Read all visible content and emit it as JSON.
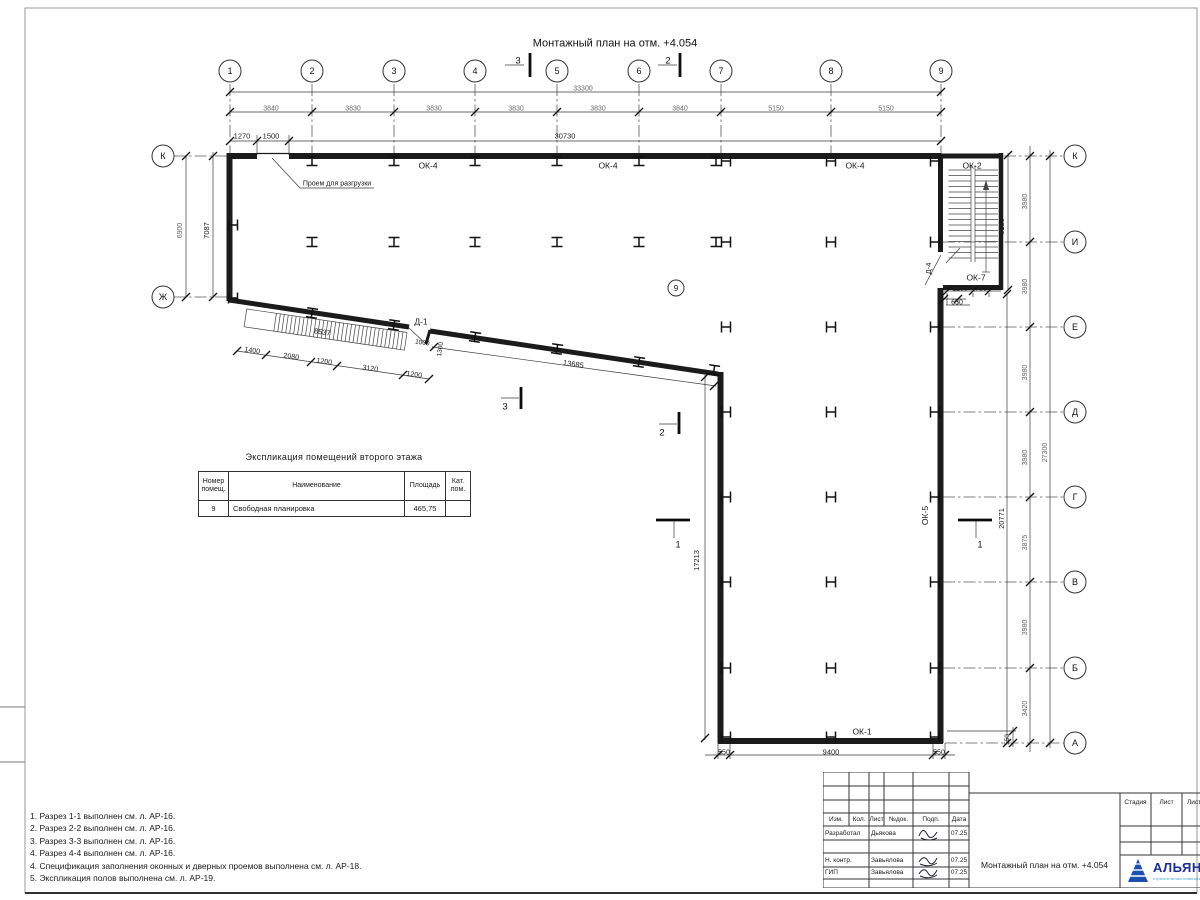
{
  "sheet_title": "Монтажный план на отм. +4.054",
  "axes": {
    "numbers": [
      "1",
      "2",
      "3",
      "4",
      "5",
      "6",
      "7",
      "8",
      "9"
    ],
    "letters_left": [
      "К",
      "Ж"
    ],
    "letters_right": [
      "К",
      "И",
      "Е",
      "Д",
      "Г",
      "В",
      "Б",
      "А"
    ],
    "room_number": "9"
  },
  "expl_table": {
    "title": "Экспликация помещений второго этажа",
    "col_headers": [
      "Номер помещ.",
      "Наименование",
      "Площадь",
      "Кат. пом."
    ],
    "row": {
      "num": "9",
      "name": "Свободная планировка",
      "area": "465,75",
      "cat": ""
    }
  },
  "notes": [
    "1. Разрез 1-1 выполнен см. л. АР-16.",
    "2. Разрез 2-2 выполнен см. л. АР-16.",
    "3. Разрез 3-3 выполнен см. л. АР-16.",
    "4. Разрез 4-4 выполнен см. л. АР-16.",
    "4. Спецификация заполнения оконных и дверных проемов выполнена см. л. АР-18.",
    "5. Экспликация полов выполнена см. л. АР-19."
  ],
  "titleblock": {
    "header_cells": [
      "Изм.",
      "Кол.",
      "Лист",
      "№док.",
      "Подп.",
      "Дата"
    ],
    "rows": [
      [
        "Разработал",
        "Дьякова",
        "07.25"
      ],
      [
        "Н. контр.",
        "Завьялова",
        "07.25"
      ],
      [
        "ГИП",
        "Завьялова",
        "07.25"
      ]
    ],
    "doc_title": "Монтажный план на отм. +4.054",
    "stage_headers": [
      "Стадия",
      "Лист",
      "Листов"
    ],
    "logo_name": "АЛЬЯНС",
    "logo_sub": "строительная компания",
    "logo_color": "#1d2f8f",
    "logo_accent": "#2a9fd4"
  },
  "plan": {
    "dash": [
      [
        230,
        84,
        230,
        158
      ],
      [
        312,
        84,
        312,
        158
      ],
      [
        394,
        84,
        394,
        158
      ],
      [
        475,
        84,
        475,
        158
      ],
      [
        557,
        84,
        557,
        158
      ],
      [
        639,
        84,
        639,
        158
      ],
      [
        721,
        84,
        721,
        158
      ],
      [
        831,
        84,
        831,
        158
      ],
      [
        941,
        84,
        941,
        158
      ],
      [
        174,
        156,
        228,
        156
      ],
      [
        174,
        297,
        228,
        297
      ],
      [
        1004,
        156,
        1064,
        156
      ],
      [
        943,
        242,
        1064,
        242
      ],
      [
        943,
        327,
        1064,
        327
      ],
      [
        943,
        412,
        1064,
        412
      ],
      [
        943,
        497,
        1064,
        497
      ],
      [
        943,
        582,
        1064,
        582
      ],
      [
        943,
        668,
        1064,
        668
      ],
      [
        945,
        743,
        1064,
        743
      ]
    ],
    "thin": [
      [
        230,
        92,
        941,
        92
      ],
      [
        230,
        112,
        941,
        112
      ],
      [
        230,
        141,
        941,
        141
      ],
      [
        186,
        156,
        186,
        297
      ],
      [
        213,
        152,
        213,
        297
      ],
      [
        1030,
        146,
        1030,
        752
      ],
      [
        1050,
        150,
        1050,
        748
      ],
      [
        1007,
        294,
        1007,
        743
      ],
      [
        1008,
        153,
        1008,
        290
      ],
      [
        944,
        291,
        1001,
        291
      ],
      [
        944,
        299,
        966,
        299
      ],
      [
        705,
        755,
        955,
        755
      ],
      [
        947,
        731,
        1016,
        731
      ],
      [
        1013,
        727,
        1013,
        747
      ],
      [
        237,
        351,
        429,
        379
      ],
      [
        432,
        347,
        716,
        386
      ],
      [
        705,
        375,
        705,
        740
      ],
      [
        257,
        135,
        257,
        155
      ],
      [
        289,
        135,
        289,
        155
      ],
      [
        718,
        743,
        718,
        759
      ],
      [
        730,
        743,
        730,
        759
      ],
      [
        933,
        743,
        933,
        759
      ],
      [
        945,
        743,
        945,
        759
      ],
      [
        947,
        293,
        947,
        305
      ],
      [
        973,
        293,
        973,
        297
      ],
      [
        989,
        293,
        989,
        297
      ],
      [
        958,
        299,
        958,
        305
      ],
      [
        272,
        158,
        300,
        188
      ],
      [
        300,
        188,
        374,
        188
      ],
      [
        946,
        305,
        970,
        305
      ],
      [
        505,
        65,
        524,
        65
      ],
      [
        658,
        65,
        677,
        65
      ],
      [
        501,
        398,
        519,
        398
      ],
      [
        659,
        424,
        677,
        424
      ],
      [
        674,
        520,
        674,
        538
      ],
      [
        976,
        520,
        976,
        538
      ],
      [
        409,
        328,
        427,
        345
      ],
      [
        941,
        255,
        925,
        285
      ],
      [
        946,
        263,
        960,
        248
      ]
    ],
    "ticks": [
      [
        230,
        92
      ],
      [
        941,
        92
      ],
      [
        230,
        112
      ],
      [
        312,
        112
      ],
      [
        394,
        112
      ],
      [
        475,
        112
      ],
      [
        557,
        112
      ],
      [
        639,
        112
      ],
      [
        721,
        112
      ],
      [
        831,
        112
      ],
      [
        941,
        112
      ],
      [
        230,
        141
      ],
      [
        257,
        141
      ],
      [
        289,
        141
      ],
      [
        941,
        141
      ],
      [
        186,
        156
      ],
      [
        186,
        297
      ],
      [
        213,
        156
      ],
      [
        213,
        297
      ],
      [
        1030,
        156
      ],
      [
        1030,
        242
      ],
      [
        1030,
        327
      ],
      [
        1030,
        412
      ],
      [
        1030,
        497
      ],
      [
        1030,
        582
      ],
      [
        1030,
        668
      ],
      [
        1030,
        743
      ],
      [
        1050,
        156
      ],
      [
        1050,
        743
      ],
      [
        1007,
        294
      ],
      [
        1007,
        743
      ],
      [
        1008,
        155
      ],
      [
        1008,
        290
      ],
      [
        947,
        291
      ],
      [
        973,
        291
      ],
      [
        989,
        291
      ],
      [
        944,
        299
      ],
      [
        958,
        299
      ],
      [
        718,
        755
      ],
      [
        730,
        755
      ],
      [
        933,
        755
      ],
      [
        945,
        755
      ],
      [
        1013,
        731
      ],
      [
        1013,
        743
      ],
      [
        237,
        351
      ],
      [
        266,
        355
      ],
      [
        311,
        362
      ],
      [
        337,
        366
      ],
      [
        403,
        375
      ],
      [
        429,
        379
      ],
      [
        434,
        347
      ],
      [
        714,
        386
      ],
      [
        705,
        377
      ],
      [
        705,
        738
      ]
    ],
    "walls": [
      [
        227,
        156,
        257,
        156,
        6
      ],
      [
        257,
        153.5,
        289,
        153.5,
        1.2
      ],
      [
        289,
        156,
        941,
        156,
        6
      ],
      [
        941,
        156,
        1003,
        156,
        5
      ],
      [
        229.5,
        153,
        229.5,
        301,
        6
      ],
      [
        229,
        300,
        409,
        327,
        5
      ],
      [
        430,
        331,
        718,
        374,
        5
      ],
      [
        430,
        330,
        426,
        344,
        3
      ],
      [
        720.5,
        372,
        720.5,
        743,
        6
      ],
      [
        718,
        741,
        943,
        741,
        6
      ],
      [
        940.5,
        156,
        940.5,
        252,
        5
      ],
      [
        940.5,
        288,
        940.5,
        743,
        6
      ],
      [
        1001,
        153,
        1001,
        290,
        4.5
      ],
      [
        943,
        287.5,
        1003,
        287.5,
        5
      ]
    ],
    "bars": [
      [
        530,
        53,
        530,
        77
      ],
      [
        680,
        53,
        680,
        77
      ],
      [
        521,
        387,
        521,
        409
      ],
      [
        679,
        412,
        679,
        434
      ],
      [
        656,
        520,
        690,
        520
      ],
      [
        958,
        520,
        992,
        520
      ]
    ],
    "cols": [
      [
        312,
        161,
        "v",
        0
      ],
      [
        394,
        161,
        "v",
        0
      ],
      [
        475,
        161,
        "v",
        0
      ],
      [
        557,
        161,
        "v",
        0
      ],
      [
        639,
        161,
        "v",
        0
      ],
      [
        716,
        161,
        "v",
        0
      ],
      [
        726,
        161,
        "h",
        0
      ],
      [
        831,
        161,
        "h",
        0
      ],
      [
        935,
        161,
        "h",
        0
      ],
      [
        312,
        242,
        "v",
        0
      ],
      [
        394,
        242,
        "v",
        0
      ],
      [
        475,
        242,
        "v",
        0
      ],
      [
        557,
        242,
        "v",
        0
      ],
      [
        639,
        242,
        "v",
        0
      ],
      [
        716,
        242,
        "v",
        0
      ],
      [
        726,
        242,
        "h",
        0
      ],
      [
        831,
        242,
        "h",
        0
      ],
      [
        935,
        242,
        "h",
        0
      ],
      [
        233,
        225,
        "h",
        0
      ],
      [
        233,
        298,
        "h",
        0
      ],
      [
        312,
        313,
        "v",
        8.3
      ],
      [
        394,
        325,
        "v",
        8.3
      ],
      [
        475,
        337,
        "v",
        8.3
      ],
      [
        557,
        349,
        "v",
        8.3
      ],
      [
        639,
        362,
        "v",
        8.3
      ],
      [
        714,
        370,
        "v",
        8.3
      ],
      [
        726,
        327,
        "h",
        0
      ],
      [
        831,
        327,
        "h",
        0
      ],
      [
        935,
        327,
        "h",
        0
      ],
      [
        726,
        412,
        "h",
        0
      ],
      [
        831,
        412,
        "h",
        0
      ],
      [
        935,
        412,
        "h",
        0
      ],
      [
        726,
        497,
        "h",
        0
      ],
      [
        831,
        497,
        "h",
        0
      ],
      [
        935,
        497,
        "h",
        0
      ],
      [
        726,
        582,
        "h",
        0
      ],
      [
        831,
        582,
        "h",
        0
      ],
      [
        935,
        582,
        "h",
        0
      ],
      [
        726,
        668,
        "h",
        0
      ],
      [
        831,
        668,
        "h",
        0
      ],
      [
        935,
        668,
        "h",
        0
      ],
      [
        726,
        737,
        "h",
        0
      ],
      [
        831,
        737,
        "h",
        0
      ],
      [
        935,
        737,
        "h",
        0
      ]
    ],
    "bubs": [
      [
        "1",
        230,
        71,
        11
      ],
      [
        "2",
        312,
        71,
        11
      ],
      [
        "3",
        394,
        71,
        11
      ],
      [
        "4",
        475,
        71,
        11
      ],
      [
        "5",
        557,
        71,
        11
      ],
      [
        "6",
        639,
        71,
        11
      ],
      [
        "7",
        721,
        71,
        11
      ],
      [
        "8",
        831,
        71,
        11
      ],
      [
        "9",
        941,
        71,
        11
      ],
      [
        "К",
        163,
        156,
        11
      ],
      [
        "Ж",
        163,
        297,
        11
      ],
      [
        "К",
        1075,
        156,
        11
      ],
      [
        "И",
        1075,
        242,
        11
      ],
      [
        "Е",
        1075,
        327,
        11
      ],
      [
        "Д",
        1075,
        412,
        11
      ],
      [
        "Г",
        1075,
        497,
        11
      ],
      [
        "В",
        1075,
        582,
        11
      ],
      [
        "Б",
        1075,
        668,
        11
      ],
      [
        "А",
        1075,
        743,
        11
      ],
      [
        "9",
        676,
        288,
        8
      ]
    ],
    "ann": [
      [
        "Монтажный план на отм. +4.054",
        615,
        44,
        11,
        0,
        "#111"
      ],
      [
        "33300",
        583,
        88,
        7,
        0,
        "#666"
      ],
      [
        "3840",
        271,
        108,
        7,
        0,
        "#666"
      ],
      [
        "3830",
        353,
        108,
        7,
        0,
        "#666"
      ],
      [
        "3830",
        434,
        108,
        7,
        0,
        "#666"
      ],
      [
        "3830",
        516,
        108,
        7,
        0,
        "#666"
      ],
      [
        "3830",
        598,
        108,
        7,
        0,
        "#666"
      ],
      [
        "3840",
        680,
        108,
        7,
        0,
        "#666"
      ],
      [
        "5150",
        776,
        108,
        7,
        0,
        "#666"
      ],
      [
        "5150",
        886,
        108,
        7,
        0,
        "#666"
      ],
      [
        "1270",
        242,
        136,
        7.5,
        0,
        "#1a1a1a"
      ],
      [
        "1500",
        271,
        136,
        7.5,
        0,
        "#1a1a1a"
      ],
      [
        "30730",
        565,
        136,
        7.5,
        0,
        "#1a1a1a"
      ],
      [
        "6900",
        182,
        228,
        7,
        -90,
        "#666"
      ],
      [
        "7087",
        209,
        228,
        7.5,
        -90,
        "#1a1a1a"
      ],
      [
        "ОК-4",
        428,
        166,
        8.5,
        0,
        "#1a1a1a"
      ],
      [
        "ОК-4",
        608,
        166,
        8.5,
        0,
        "#1a1a1a"
      ],
      [
        "ОК-4",
        855,
        166,
        8.5,
        0,
        "#1a1a1a"
      ],
      [
        "ОК-2",
        972,
        166,
        8.5,
        0,
        "#1a1a1a"
      ],
      [
        "Проем для разгрузки",
        337,
        183,
        7,
        0,
        "#1a1a1a"
      ],
      [
        "6180",
        1004,
        224,
        7.5,
        -90,
        "#1a1a1a"
      ],
      [
        "3980",
        1027,
        199,
        7,
        -90,
        "#666"
      ],
      [
        "3980",
        1027,
        284,
        7,
        -90,
        "#666"
      ],
      [
        "3980",
        1027,
        370,
        7,
        -90,
        "#666"
      ],
      [
        "3980",
        1027,
        455,
        7,
        -90,
        "#666"
      ],
      [
        "3875",
        1027,
        540,
        7,
        -90,
        "#666"
      ],
      [
        "3980",
        1027,
        625,
        7,
        -90,
        "#666"
      ],
      [
        "3420",
        1027,
        706,
        7,
        -90,
        "#666"
      ],
      [
        "27300",
        1047,
        450,
        7,
        -90,
        "#666"
      ],
      [
        "20771",
        1004,
        516,
        7.5,
        -90,
        "#1a1a1a"
      ],
      [
        "Д-4",
        931,
        266,
        7.5,
        -90,
        "#1a1a1a"
      ],
      [
        "ОК-7",
        976,
        278,
        8.5,
        0,
        "#1a1a1a"
      ],
      [
        "1200",
        960,
        288,
        7,
        0,
        "#1a1a1a"
      ],
      [
        "750",
        981,
        288,
        7,
        0,
        "#1a1a1a"
      ],
      [
        "650",
        957,
        302,
        7,
        0,
        "#1a1a1a"
      ],
      [
        "Д-1",
        421,
        322,
        8.5,
        0,
        "#1a1a1a"
      ],
      [
        "8537",
        322,
        332,
        7.5,
        8.3,
        "#1a1a1a"
      ],
      [
        "1400",
        252,
        350,
        7,
        8.3,
        "#1a1a1a"
      ],
      [
        "2080",
        291,
        356,
        7,
        8.3,
        "#1a1a1a"
      ],
      [
        "1200",
        324,
        361,
        7,
        8.3,
        "#1a1a1a"
      ],
      [
        "3120",
        370,
        368,
        7,
        8.3,
        "#1a1a1a"
      ],
      [
        "1200",
        414,
        374,
        7,
        8.3,
        "#1a1a1a"
      ],
      [
        "1000",
        422,
        342,
        6.5,
        8.3,
        "#1a1a1a"
      ],
      [
        "1300",
        442,
        347,
        6.5,
        -82,
        "#1a1a1a"
      ],
      [
        "13685",
        573,
        364,
        7.5,
        8.3,
        "#1a1a1a"
      ],
      [
        "17213",
        699,
        558,
        7.5,
        -90,
        "#1a1a1a"
      ],
      [
        "ОК-5",
        928,
        513,
        8.5,
        -90,
        "#1a1a1a"
      ],
      [
        "ОК-1",
        862,
        732,
        8.5,
        0,
        "#1a1a1a"
      ],
      [
        "550",
        724,
        752,
        7,
        0,
        "#1a1a1a"
      ],
      [
        "9400",
        831,
        752,
        7.5,
        0,
        "#1a1a1a"
      ],
      [
        "550",
        939,
        752,
        7,
        0,
        "#1a1a1a"
      ],
      [
        "550",
        1009,
        737,
        6.5,
        -90,
        "#1a1a1a"
      ],
      [
        "3",
        518,
        61,
        9.5,
        0,
        "#111"
      ],
      [
        "2",
        668,
        61,
        9.5,
        0,
        "#111"
      ],
      [
        "3",
        505,
        407,
        9.5,
        0,
        "#111"
      ],
      [
        "2",
        662,
        433,
        9.5,
        0,
        "#111"
      ],
      [
        "1",
        678,
        545,
        9,
        0,
        "#111"
      ],
      [
        "1",
        980,
        545,
        9,
        0,
        "#111"
      ]
    ],
    "stairs": {
      "x1": 948.5,
      "x2": 998,
      "m1": 971,
      "m2": 975,
      "y1": 170,
      "y2": 258,
      "step": 5.5,
      "ax": 986,
      "ay1": 272,
      "ay2": 182
    },
    "band": {
      "x": 247,
      "y": 307,
      "r": 8.3,
      "len": 162,
      "h": 18,
      "start": 30,
      "step": 4
    }
  }
}
